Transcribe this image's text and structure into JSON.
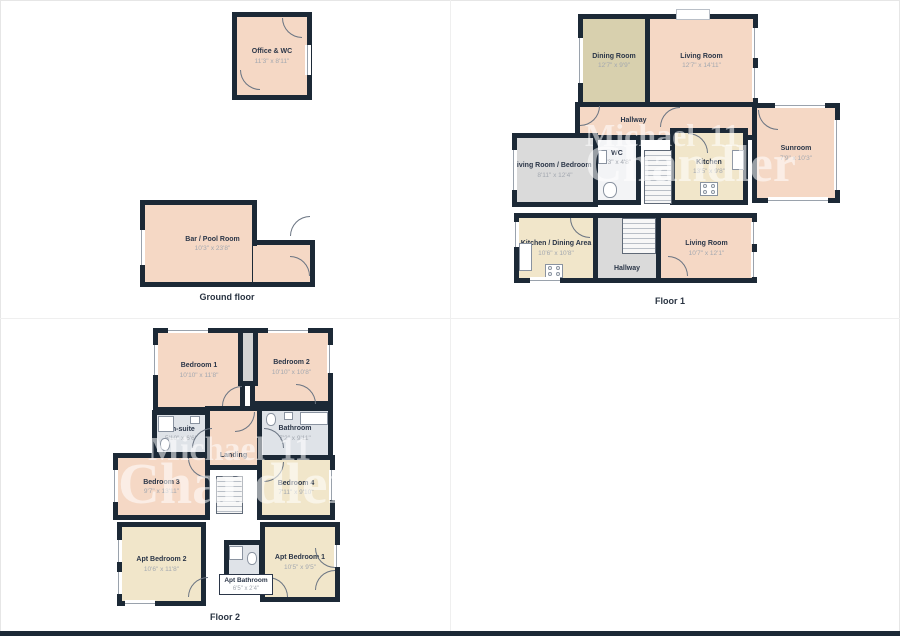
{
  "watermark": {
    "name_line": "Michael",
    "mark": "11",
    "surname_line": "Chandler"
  },
  "colors": {
    "wall": "#1c2936",
    "pink": "#f5d8c5",
    "tan": "#d8d0ae",
    "cream": "#f1e6ca",
    "gray": "#dadada",
    "bath_gray": "#dfe3e8",
    "bottom_bar": "#1c2936"
  },
  "floors": {
    "ground": {
      "label": "Ground floor",
      "rooms": {
        "office_wc": {
          "label": "Office & WC",
          "dims": "11'3\" x 8'11\""
        },
        "bar_pool": {
          "label": "Bar / Pool Room",
          "dims": "10'3\" x 23'8\""
        }
      }
    },
    "floor1": {
      "label": "Floor 1",
      "rooms": {
        "dining": {
          "label": "Dining Room",
          "dims": "12'7\" x 9'9\""
        },
        "living_top": {
          "label": "Living Room",
          "dims": "12'7\" x 14'11\""
        },
        "hallway_top": {
          "label": "Hallway",
          "dims": ""
        },
        "lr_bed5": {
          "label": "Living Room / Bedroom 5",
          "dims": "8'11\" x 12'4\""
        },
        "wc": {
          "label": "WC",
          "dims": "3'3\" x 4'8\""
        },
        "kitchen": {
          "label": "Kitchen",
          "dims": "13'5\" x 9'8\""
        },
        "sunroom": {
          "label": "Sunroom",
          "dims": "7'9\" x 10'3\""
        },
        "kitchen_dining": {
          "label": "Kitchen / Dining Area",
          "dims": "10'6\" x 10'8\""
        },
        "hallway_lower": {
          "label": "Hallway",
          "dims": ""
        },
        "living_lower": {
          "label": "Living Room",
          "dims": "10'7\" x 12'1\""
        }
      }
    },
    "floor2": {
      "label": "Floor 2",
      "rooms": {
        "bedroom1": {
          "label": "Bedroom 1",
          "dims": "10'10\" x 11'8\""
        },
        "bedroom2": {
          "label": "Bedroom 2",
          "dims": "10'10\" x 10'8\""
        },
        "ensuite": {
          "label": "En-suite",
          "dims": "5'10\" x 6'6\""
        },
        "bathroom": {
          "label": "Bathroom",
          "dims": "7'2\" x 9'11\""
        },
        "landing": {
          "label": "Landing",
          "dims": ""
        },
        "bedroom3": {
          "label": "Bedroom 3",
          "dims": "9'7\" x 13'11\""
        },
        "bedroom4": {
          "label": "Bedroom 4",
          "dims": "7'11\" x 9'10\""
        },
        "apt_bedroom2": {
          "label": "Apt Bedroom 2",
          "dims": "10'6\" x 11'8\""
        },
        "apt_bathroom": {
          "label": "Apt Bathroom",
          "dims": "6'5\" x 2'4\""
        },
        "apt_bedroom1": {
          "label": "Apt Bedroom 1",
          "dims": "10'5\" x 9'5\""
        }
      }
    }
  }
}
